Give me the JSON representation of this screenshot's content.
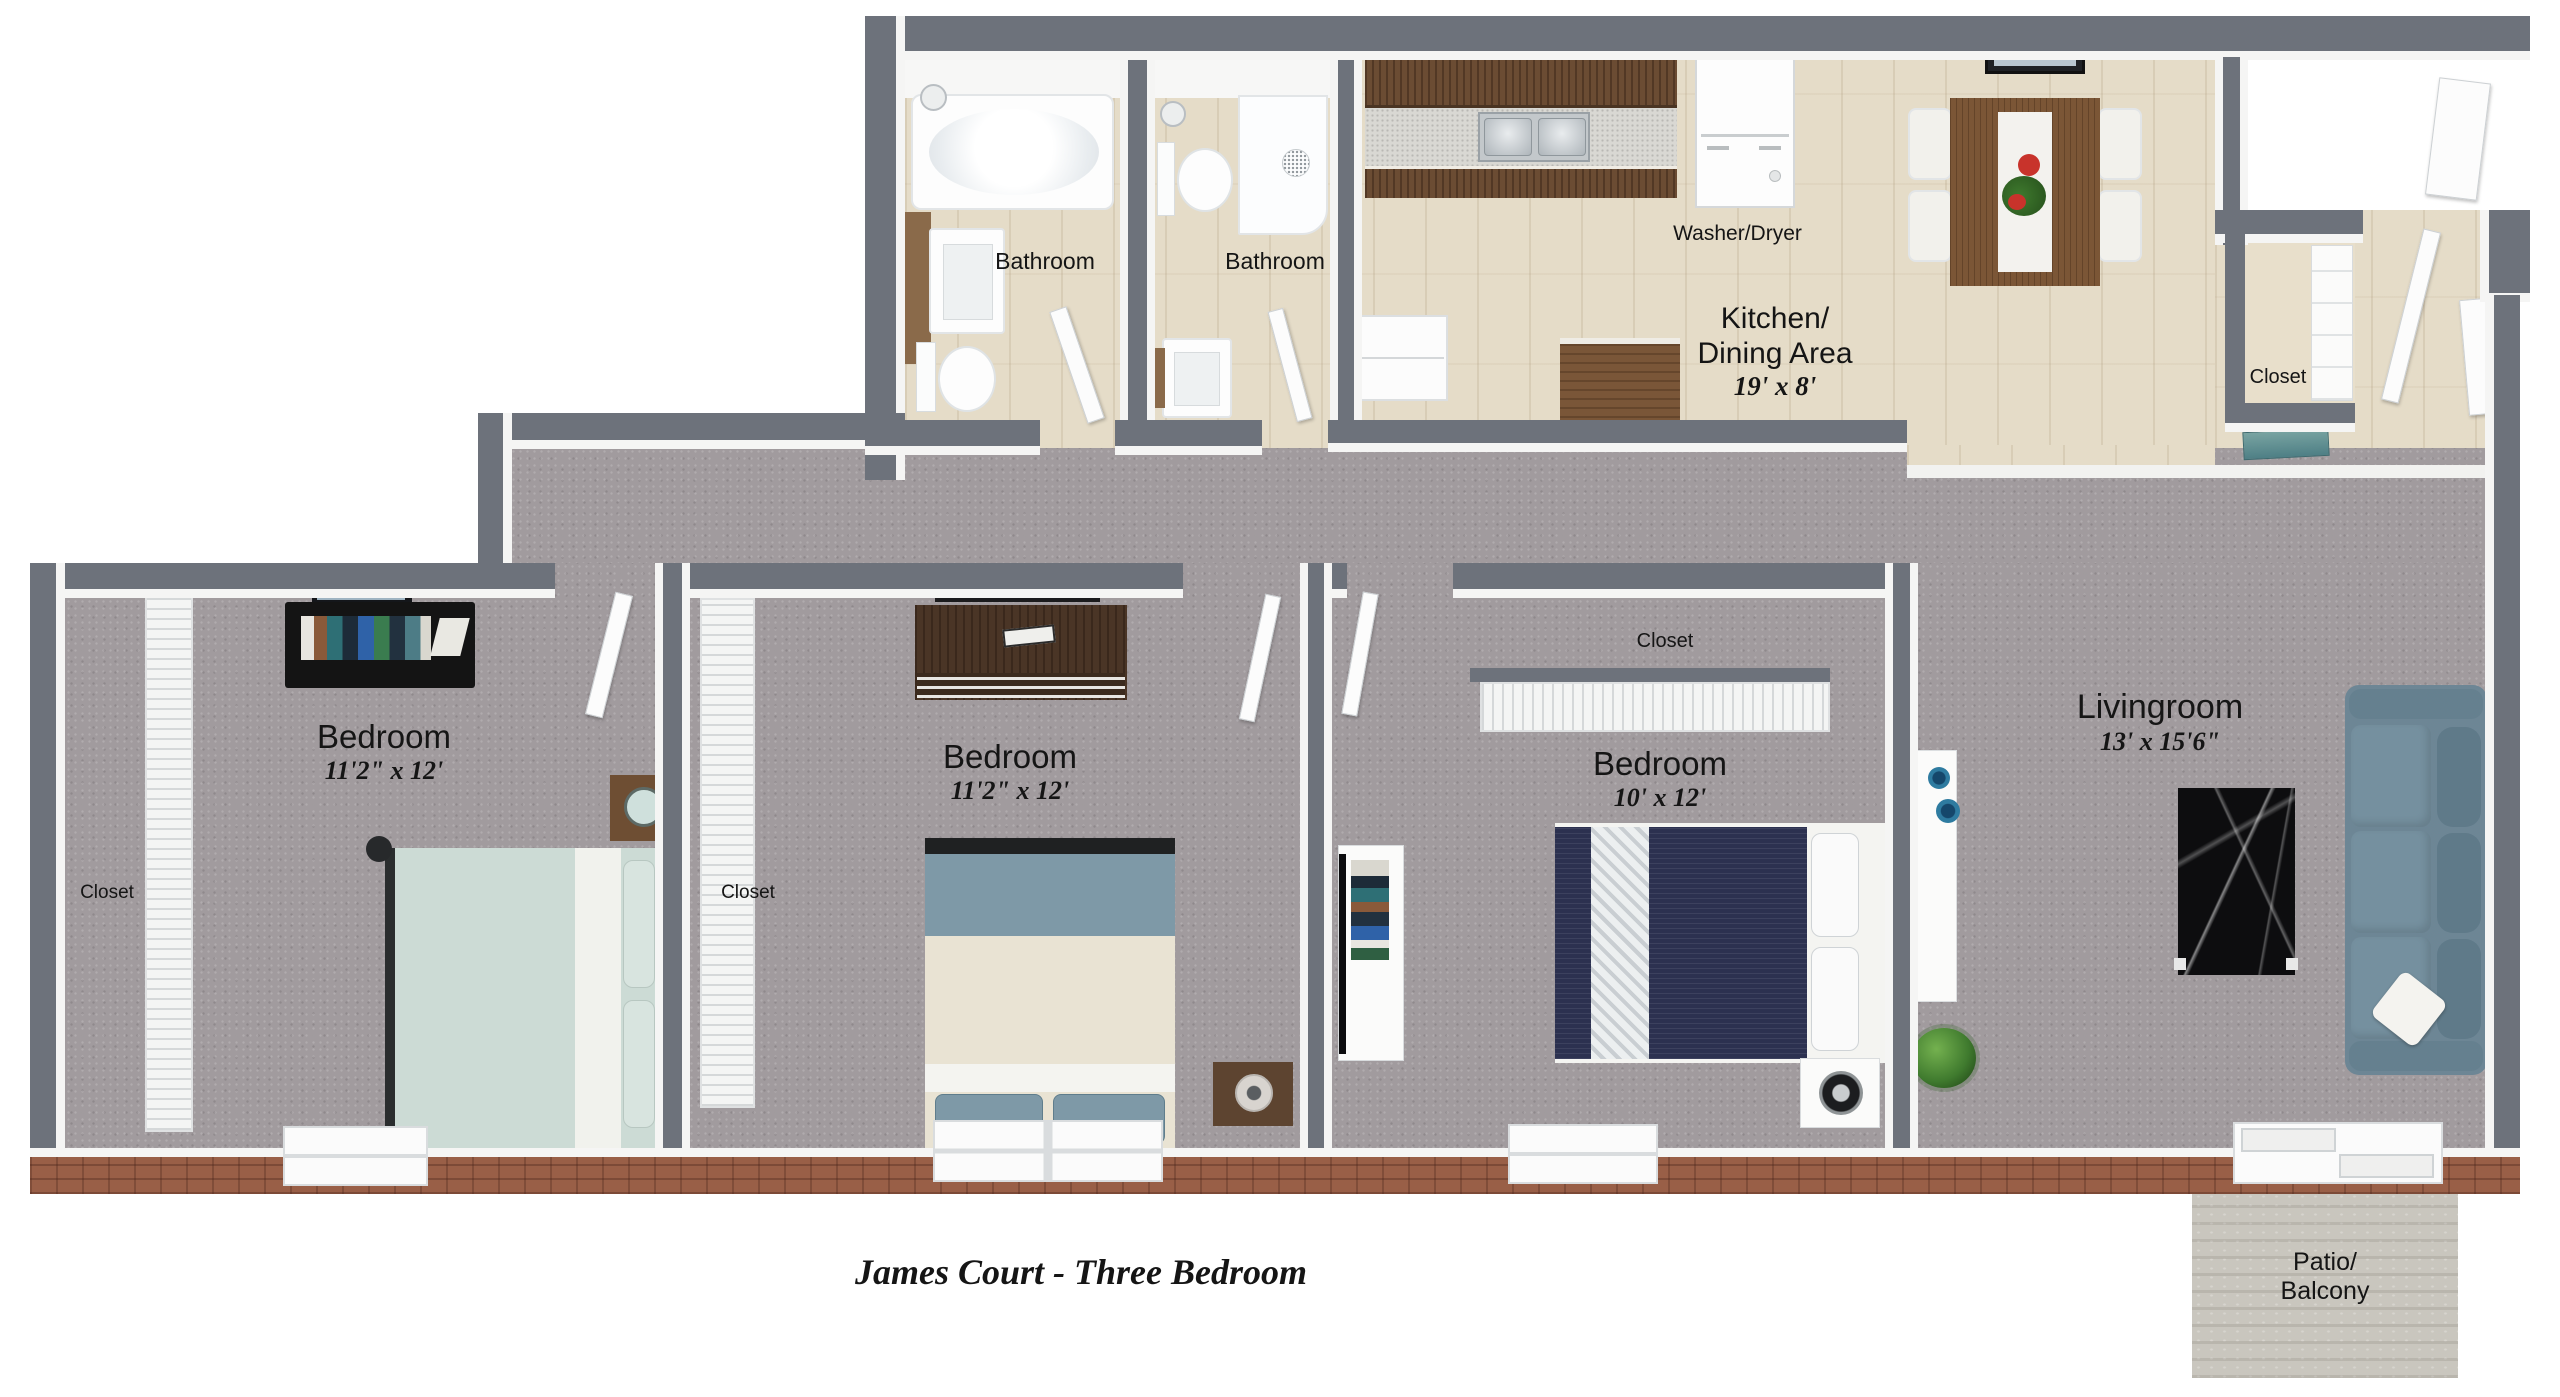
{
  "title": "James Court - Three Bedroom",
  "colors": {
    "wall": "#6d727b",
    "carpet": "#a19b9e",
    "wood_floor": "#e5dcc8",
    "brick_wall": "#995f47",
    "patio_concrete": "#c9c6be",
    "sofa": "#6d8695",
    "bed_navy": "#2c3150",
    "bed_mint": "#ccdbd5"
  },
  "rooms": {
    "bathroom1": {
      "label": "Bathroom"
    },
    "bathroom2": {
      "label": "Bathroom"
    },
    "kitchen": {
      "label_line1": "Kitchen/",
      "label_line2": "Dining Area",
      "dims": "19' x 8'"
    },
    "bedroom1": {
      "label": "Bedroom",
      "dims": "11'2\" x 12'"
    },
    "bedroom2": {
      "label": "Bedroom",
      "dims": "11'2\" x 12'"
    },
    "bedroom3": {
      "label": "Bedroom",
      "dims": "10' x 12'"
    },
    "livingroom": {
      "label": "Livingroom",
      "dims": "13' x 15'6\""
    },
    "patio": {
      "label_line1": "Patio/",
      "label_line2": "Balcony"
    }
  },
  "labels": {
    "washer_dryer": "Washer/Dryer",
    "closet_entry": "Closet",
    "closet_bedroom1": "Closet",
    "closet_bedroom2": "Closet",
    "closet_bedroom3": "Closet"
  }
}
